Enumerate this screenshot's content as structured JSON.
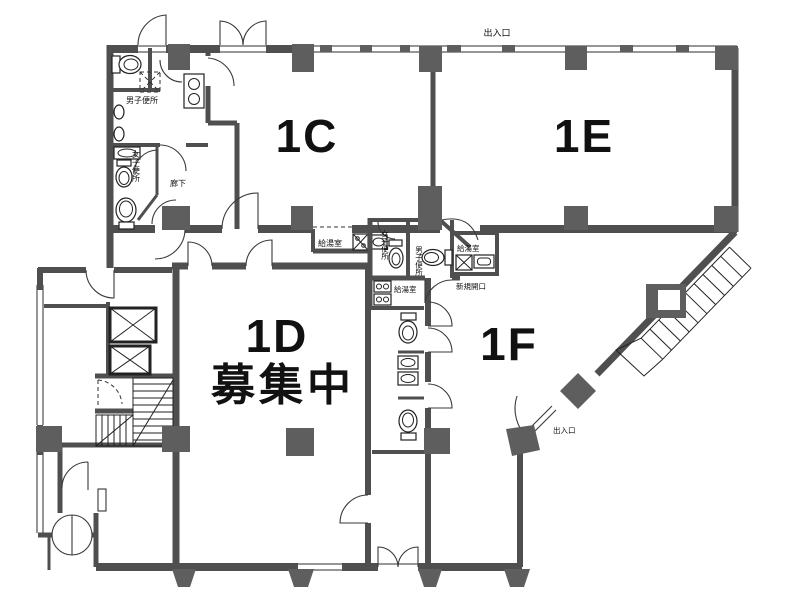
{
  "plan": {
    "units": {
      "c": {
        "label": "1C"
      },
      "e": {
        "label": "1E"
      },
      "d": {
        "label": "1D",
        "status": "募集中"
      },
      "f": {
        "label": "1F"
      }
    },
    "labels": {
      "exit_top": "出入口",
      "exit_f": "出入口",
      "mens_wc_nw": "男子便所",
      "womens_wc_nw": "女子便所",
      "corridor": "廊下",
      "kitchen_corridor": "給湯室",
      "womens_wc_mid": "女子便所",
      "mens_wc_mid": "男子便所",
      "kitchen_east": "給湯室",
      "kitchen_south": "給湯室",
      "new_opening": "新規開口"
    },
    "colors": {
      "wall": "#4f4f4f",
      "column": "#5e5e5e",
      "line": "#222222",
      "background": "#ffffff"
    }
  }
}
